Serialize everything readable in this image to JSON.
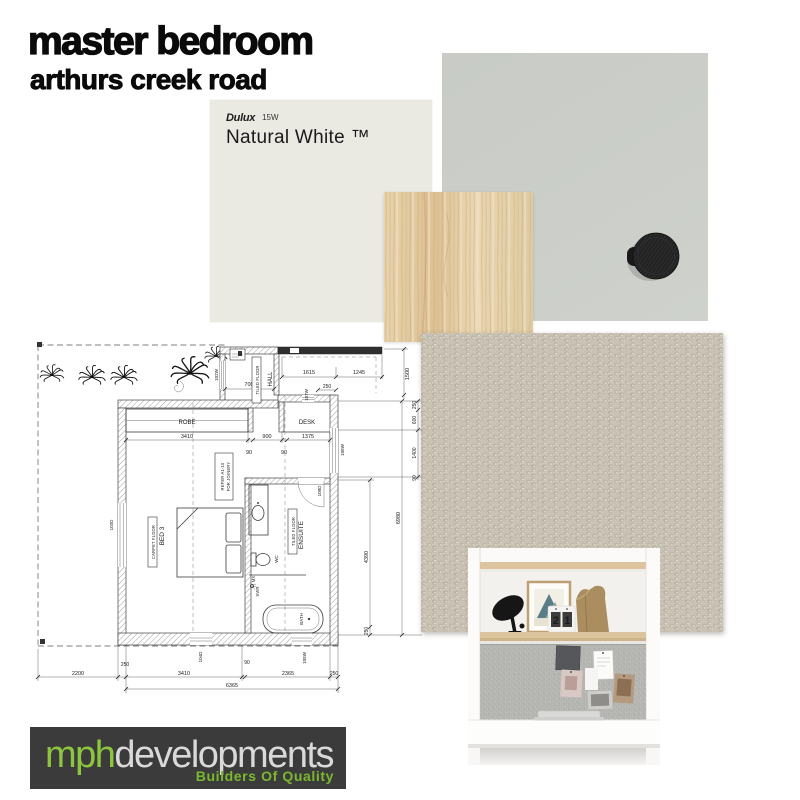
{
  "title": "master bedroom",
  "subtitle": "arthurs creek road",
  "paint_swatch": {
    "brand": "Dulux",
    "code": "15W",
    "name": "Natural White ™"
  },
  "logo": {
    "brand_green": "mph",
    "brand_light": "developments",
    "tagline": "Builders Of Quality"
  },
  "desk_photo": {
    "calendar_left": "2",
    "calendar_right": "1"
  },
  "colors": {
    "paint_natural_white": "#eae9e2",
    "paint_gray": "#caccc7",
    "timber_oak": "#e3cba4",
    "carpet_beige": "#cdc7ba",
    "knob_black": "#222222",
    "logo_background": "#3b3b3b",
    "logo_green": "#8cc63e"
  },
  "floor_plan": {
    "rooms": {
      "robe": "ROBE",
      "desk": "DESK",
      "hall": "HALL",
      "hall_floor": "TILED FLOOR",
      "bed3": "BED 3",
      "bed3_floor": "CARPET FLOOR",
      "ensuite": "ENSUITE",
      "ensuite_floor": "TILED FLOOR",
      "joinery_note_line1": "REFER A1-10",
      "joinery_note_line2": "FOR JOINERY"
    },
    "fixtures": {
      "bath": "BATH",
      "wc": "WC",
      "shower": "SWR",
      "mixer": "MX"
    },
    "openings": {
      "w102": "102W",
      "d103": "103D",
      "d104": "104D",
      "w105": "105W",
      "w106": "106W",
      "w107": "107W",
      "d108": "108D"
    },
    "dims": {
      "top_1615": "1615",
      "top_1245": "1245",
      "top_250": "250",
      "hall_700": "700",
      "right_1500": "1500",
      "mid_3410": "3410",
      "mid_900": "900",
      "mid_1375": "1375",
      "mid_90_a": "90",
      "mid_90_b": "90",
      "right_250_a": "250",
      "right_600": "600",
      "right_1400": "1400",
      "right_90": "90",
      "right_4390": "4390",
      "right_250_b": "250",
      "right_6980": "6980",
      "bottom_2200": "2200",
      "bottom_250_a": "250",
      "bottom_3410": "3410",
      "bottom_90": "90",
      "bottom_2365": "2365",
      "bottom_250_b": "250",
      "bottom_6365": "6365"
    }
  }
}
